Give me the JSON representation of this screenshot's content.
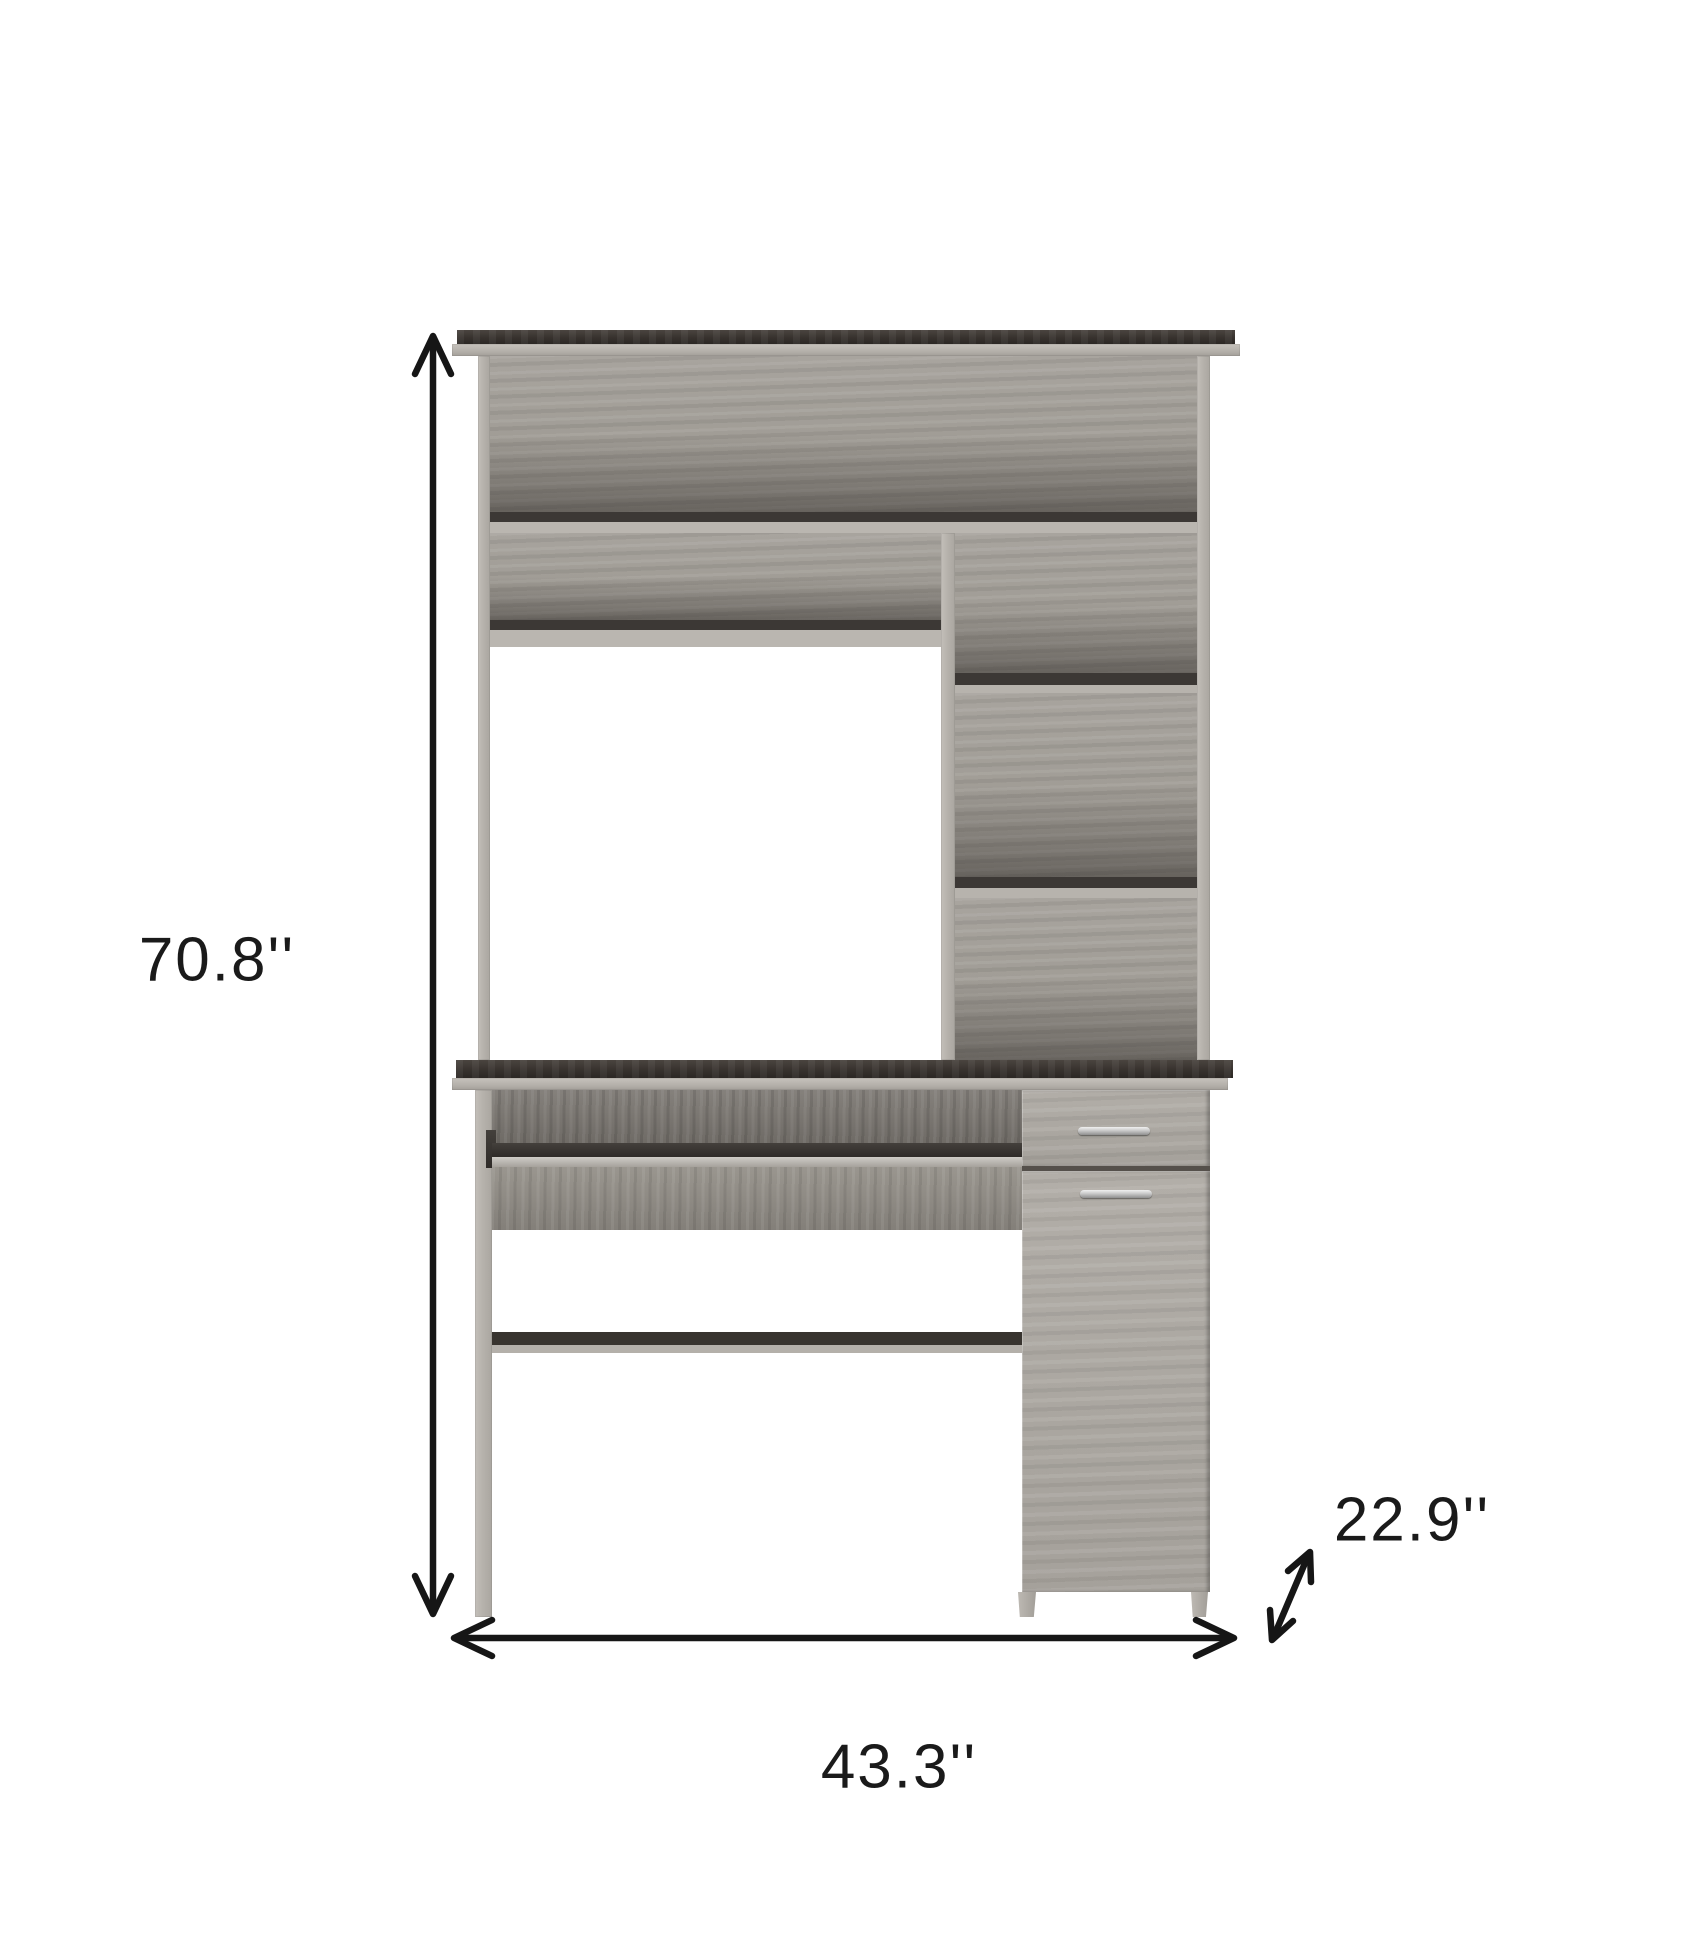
{
  "figure": {
    "type": "product-dimension-diagram",
    "subject": "computer desk with hutch",
    "dimensions": {
      "height": {
        "label": "70.8''"
      },
      "width": {
        "label": "43.3''"
      },
      "depth": {
        "label": "22.9''"
      }
    },
    "colors": {
      "background": "#ffffff",
      "arrow": "#161616",
      "label_text": "#1a1a1a",
      "espresso_top": "#37322e",
      "wood_grey": "#9d9993",
      "frame_grey": "#b6b2ac",
      "handle_silver": "#d8d8d8"
    }
  }
}
